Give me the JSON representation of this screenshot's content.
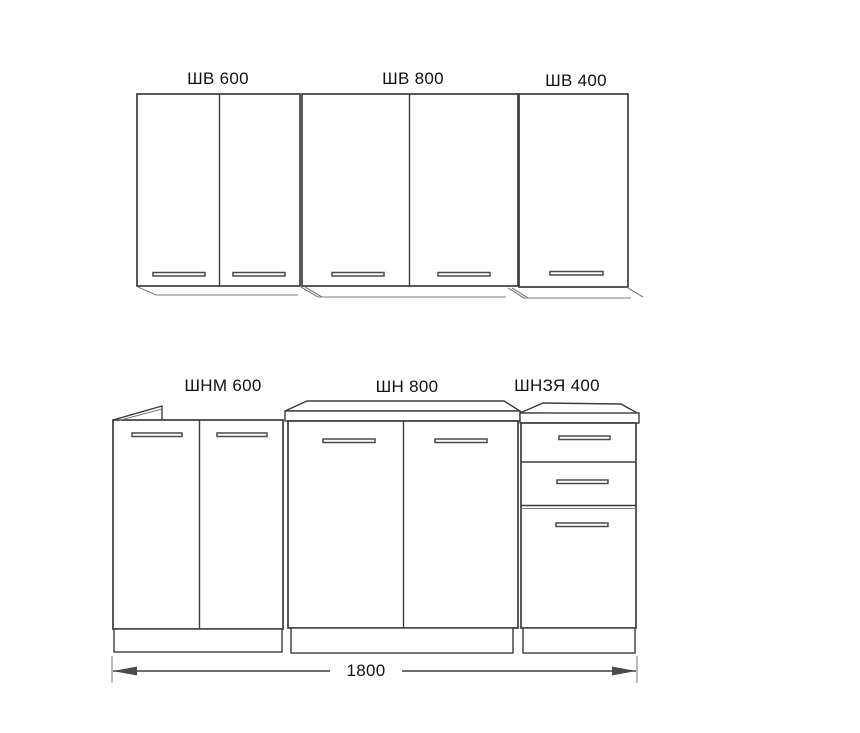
{
  "diagram": {
    "title": "Kitchen cabinet set elevation, 1800 mm",
    "wall_cabinets": [
      {
        "id": "shv-600",
        "label": "ШВ 600",
        "doors": 2
      },
      {
        "id": "shv-800",
        "label": "ШВ 800",
        "doors": 2
      },
      {
        "id": "shv-400",
        "label": "ШВ 400",
        "doors": 1
      }
    ],
    "base_cabinets": [
      {
        "id": "shnm-600",
        "label": "ШНМ 600",
        "doors": 2,
        "drawers": 0
      },
      {
        "id": "shn-800",
        "label": "ШН 800",
        "doors": 2,
        "drawers": 0
      },
      {
        "id": "shnzya-400",
        "label": "ШНЗЯ 400",
        "doors": 1,
        "drawers": 2
      }
    ],
    "dimension": {
      "value": "1800"
    },
    "colors": {
      "line": "#3c3c3c",
      "text": "#111111",
      "bg": "#ffffff"
    }
  }
}
